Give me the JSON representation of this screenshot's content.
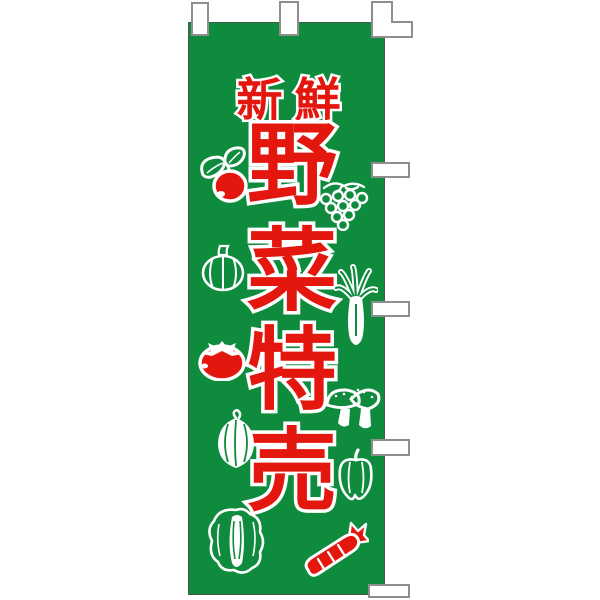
{
  "banner": {
    "header_text": "新鮮",
    "vertical_chars": [
      "野",
      "菜",
      "特",
      "売"
    ]
  },
  "colors": {
    "page_bg": "#ffffff",
    "green": "#0e8b3d",
    "red": "#e3170d",
    "white": "#ffffff",
    "tab_border": "#8e8e8e",
    "banner_edge": "#41584a"
  },
  "icons": [
    "radish-icon",
    "grapes-icon",
    "pumpkin-icon",
    "leek-icon",
    "tomato-icon",
    "mushrooms-icon",
    "onion-icon",
    "bell-pepper-icon",
    "napa-cabbage-icon",
    "carrot-icon"
  ],
  "tabs": {
    "top_count": 3,
    "right_count": 4
  }
}
